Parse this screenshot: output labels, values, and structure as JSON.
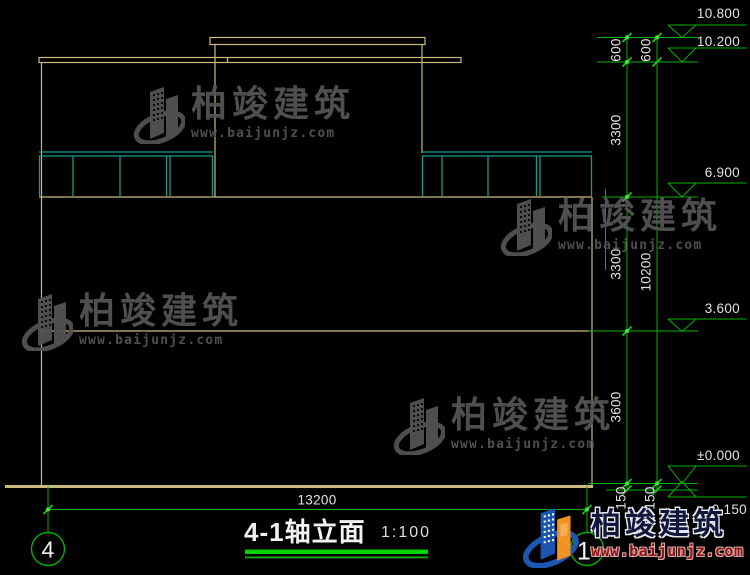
{
  "drawing": {
    "title": "4-1轴立面",
    "scale": "1:100",
    "width_dim": "13200",
    "axis_left": "4",
    "axis_right": "1",
    "levels": [
      "10.800",
      "10.200",
      "6.900",
      "3.600",
      "±0.000",
      "-0.150"
    ],
    "dims_inner": [
      "600",
      "3300",
      "3300",
      "3600",
      "150"
    ],
    "dims_outer": [
      "600",
      "10200",
      "150"
    ]
  },
  "watermark": {
    "brand": "柏竣建筑",
    "website": "www.baijunjz.com"
  },
  "logo": {
    "brand": "柏竣建筑",
    "website": "www.baijunjz.com"
  },
  "colors": {
    "background": "#000000",
    "outline": "#C9BB80",
    "railing": "#18998C",
    "dimension": "#00B200",
    "grip": "#49E549",
    "text": "#E2E2E2",
    "underline": "#00D300"
  }
}
